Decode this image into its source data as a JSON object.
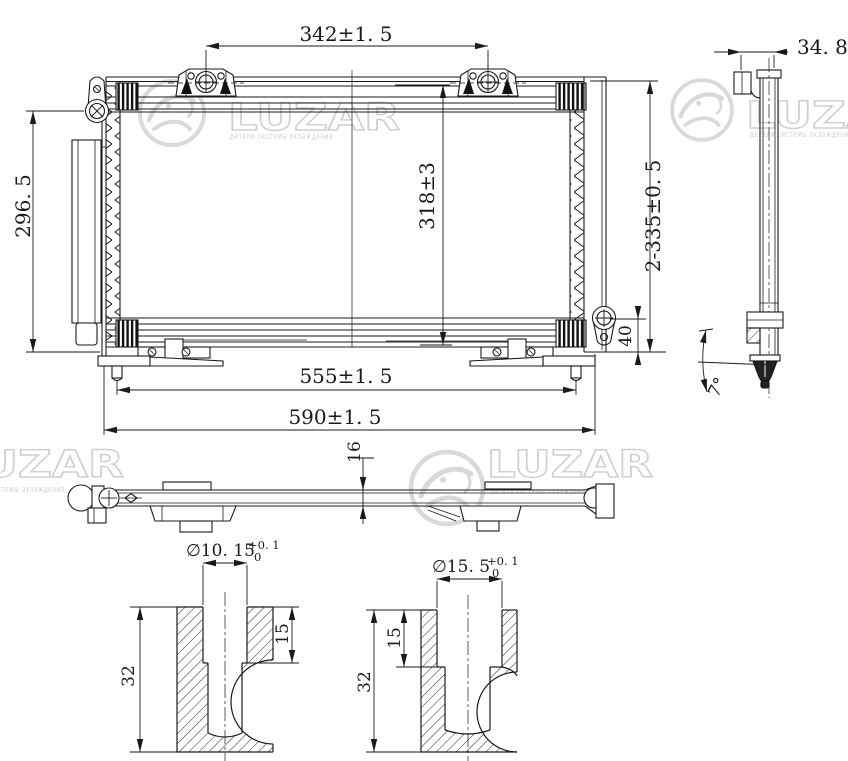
{
  "front_view": {
    "dim_top_mount_spacing": "342±1. 5",
    "dim_left_height": "296. 5",
    "dim_core_height": "318±3",
    "dim_overall_height": "2-335±0. 5",
    "dim_bottom_bracket": "40",
    "dim_bottom_pin_spacing": "555±1. 5",
    "dim_overall_width": "590±1. 5"
  },
  "side_view": {
    "dim_depth": "34. 8",
    "dim_angle": "7°"
  },
  "top_view": {
    "dim_thickness": "16"
  },
  "sections": {
    "left": {
      "dim_bore": "∅10. 15",
      "tol_upper": "+0. 1",
      "tol_lower": "0",
      "dim_depth_total": "32",
      "dim_depth_bore": "15"
    },
    "right": {
      "dim_bore": "∅15. 5",
      "tol_upper": "+0. 1",
      "tol_lower": "0",
      "dim_depth_total": "32",
      "dim_depth_bore": "15"
    }
  },
  "watermark": {
    "brand": "LUZAR",
    "subtitle": "детали системы охлаждения",
    "color": "#d6d6d6"
  },
  "colors": {
    "line": "#1a1a1a",
    "background": "#ffffff"
  }
}
